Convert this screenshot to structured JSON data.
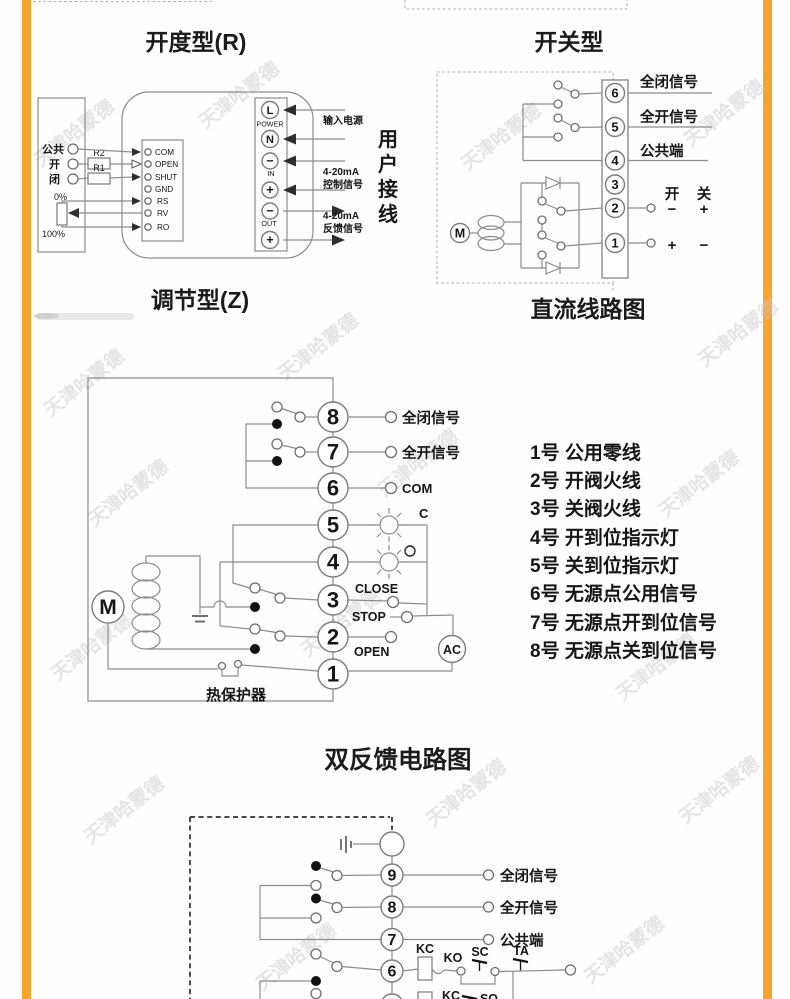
{
  "colors": {
    "accent": "#F6A42C"
  },
  "watermark": "天津哈蒙德",
  "regulating": {
    "title": "开度型(R)",
    "subtitle": "调节型(Z)",
    "input_terminals": [
      "公共",
      "开",
      "闭"
    ],
    "resistors": [
      "R2",
      "R1"
    ],
    "pot": {
      "top": "0%",
      "bottom": "100%"
    },
    "block_terminals": [
      "COM",
      "OPEN",
      "SHUT",
      "GND",
      "RS",
      "RV",
      "RO"
    ],
    "power_column": {
      "t1": "L",
      "t2": "N",
      "t3": "−",
      "t4": "+",
      "t5": "−",
      "t6": "+",
      "g1": "POWER",
      "g2": "IN",
      "g3": "OUT"
    },
    "wire_labels": {
      "power": "输入电源",
      "in1": "4-20mA",
      "in2": "控制信号",
      "out1": "4-20mA",
      "out2": "反馈信号"
    },
    "side_note": [
      "用",
      "户",
      "接",
      "线"
    ]
  },
  "switch_type": {
    "title": "开关型",
    "subtitle": "直流线路图",
    "motor": "M",
    "terminals": [
      "6",
      "5",
      "4",
      "3",
      "2",
      "1"
    ],
    "labels": [
      "全闭信号",
      "全开信号",
      "公共端"
    ],
    "header": {
      "open": "开",
      "close": "关"
    },
    "row2": {
      "open": "−",
      "close": "+"
    },
    "row1": {
      "open": "+",
      "close": "−"
    }
  },
  "feedback": {
    "title": "双反馈电路图",
    "motor": "M",
    "ac": "AC",
    "terminals": [
      "8",
      "7",
      "6",
      "5",
      "4",
      "3",
      "2",
      "1"
    ],
    "labels": {
      "t8": "全闭信号",
      "t7": "全开信号",
      "t6": "COM",
      "lamp": "C",
      "t3": "CLOSE",
      "stop": "STOP",
      "t2": "OPEN",
      "thermal": "热保护器"
    },
    "legend": [
      "1号 公用零线",
      "2号 开阀火线",
      "3号 关阀火线",
      "4号 开到位指示灯",
      "5号 关到位指示灯",
      "6号 无源点公用信号",
      "7号 无源点开到位信号",
      "8号 无源点关到位信号"
    ]
  },
  "dc_feedback": {
    "terminals": [
      "9",
      "8",
      "7",
      "6",
      "5"
    ],
    "labels": {
      "t9": "全闭信号",
      "t8": "全开信号",
      "t7": "公共端"
    },
    "relays": {
      "kc": "KC",
      "ko": "KO",
      "sc": "SC",
      "ta": "TA",
      "kc2": "KC",
      "so": "SO"
    }
  }
}
